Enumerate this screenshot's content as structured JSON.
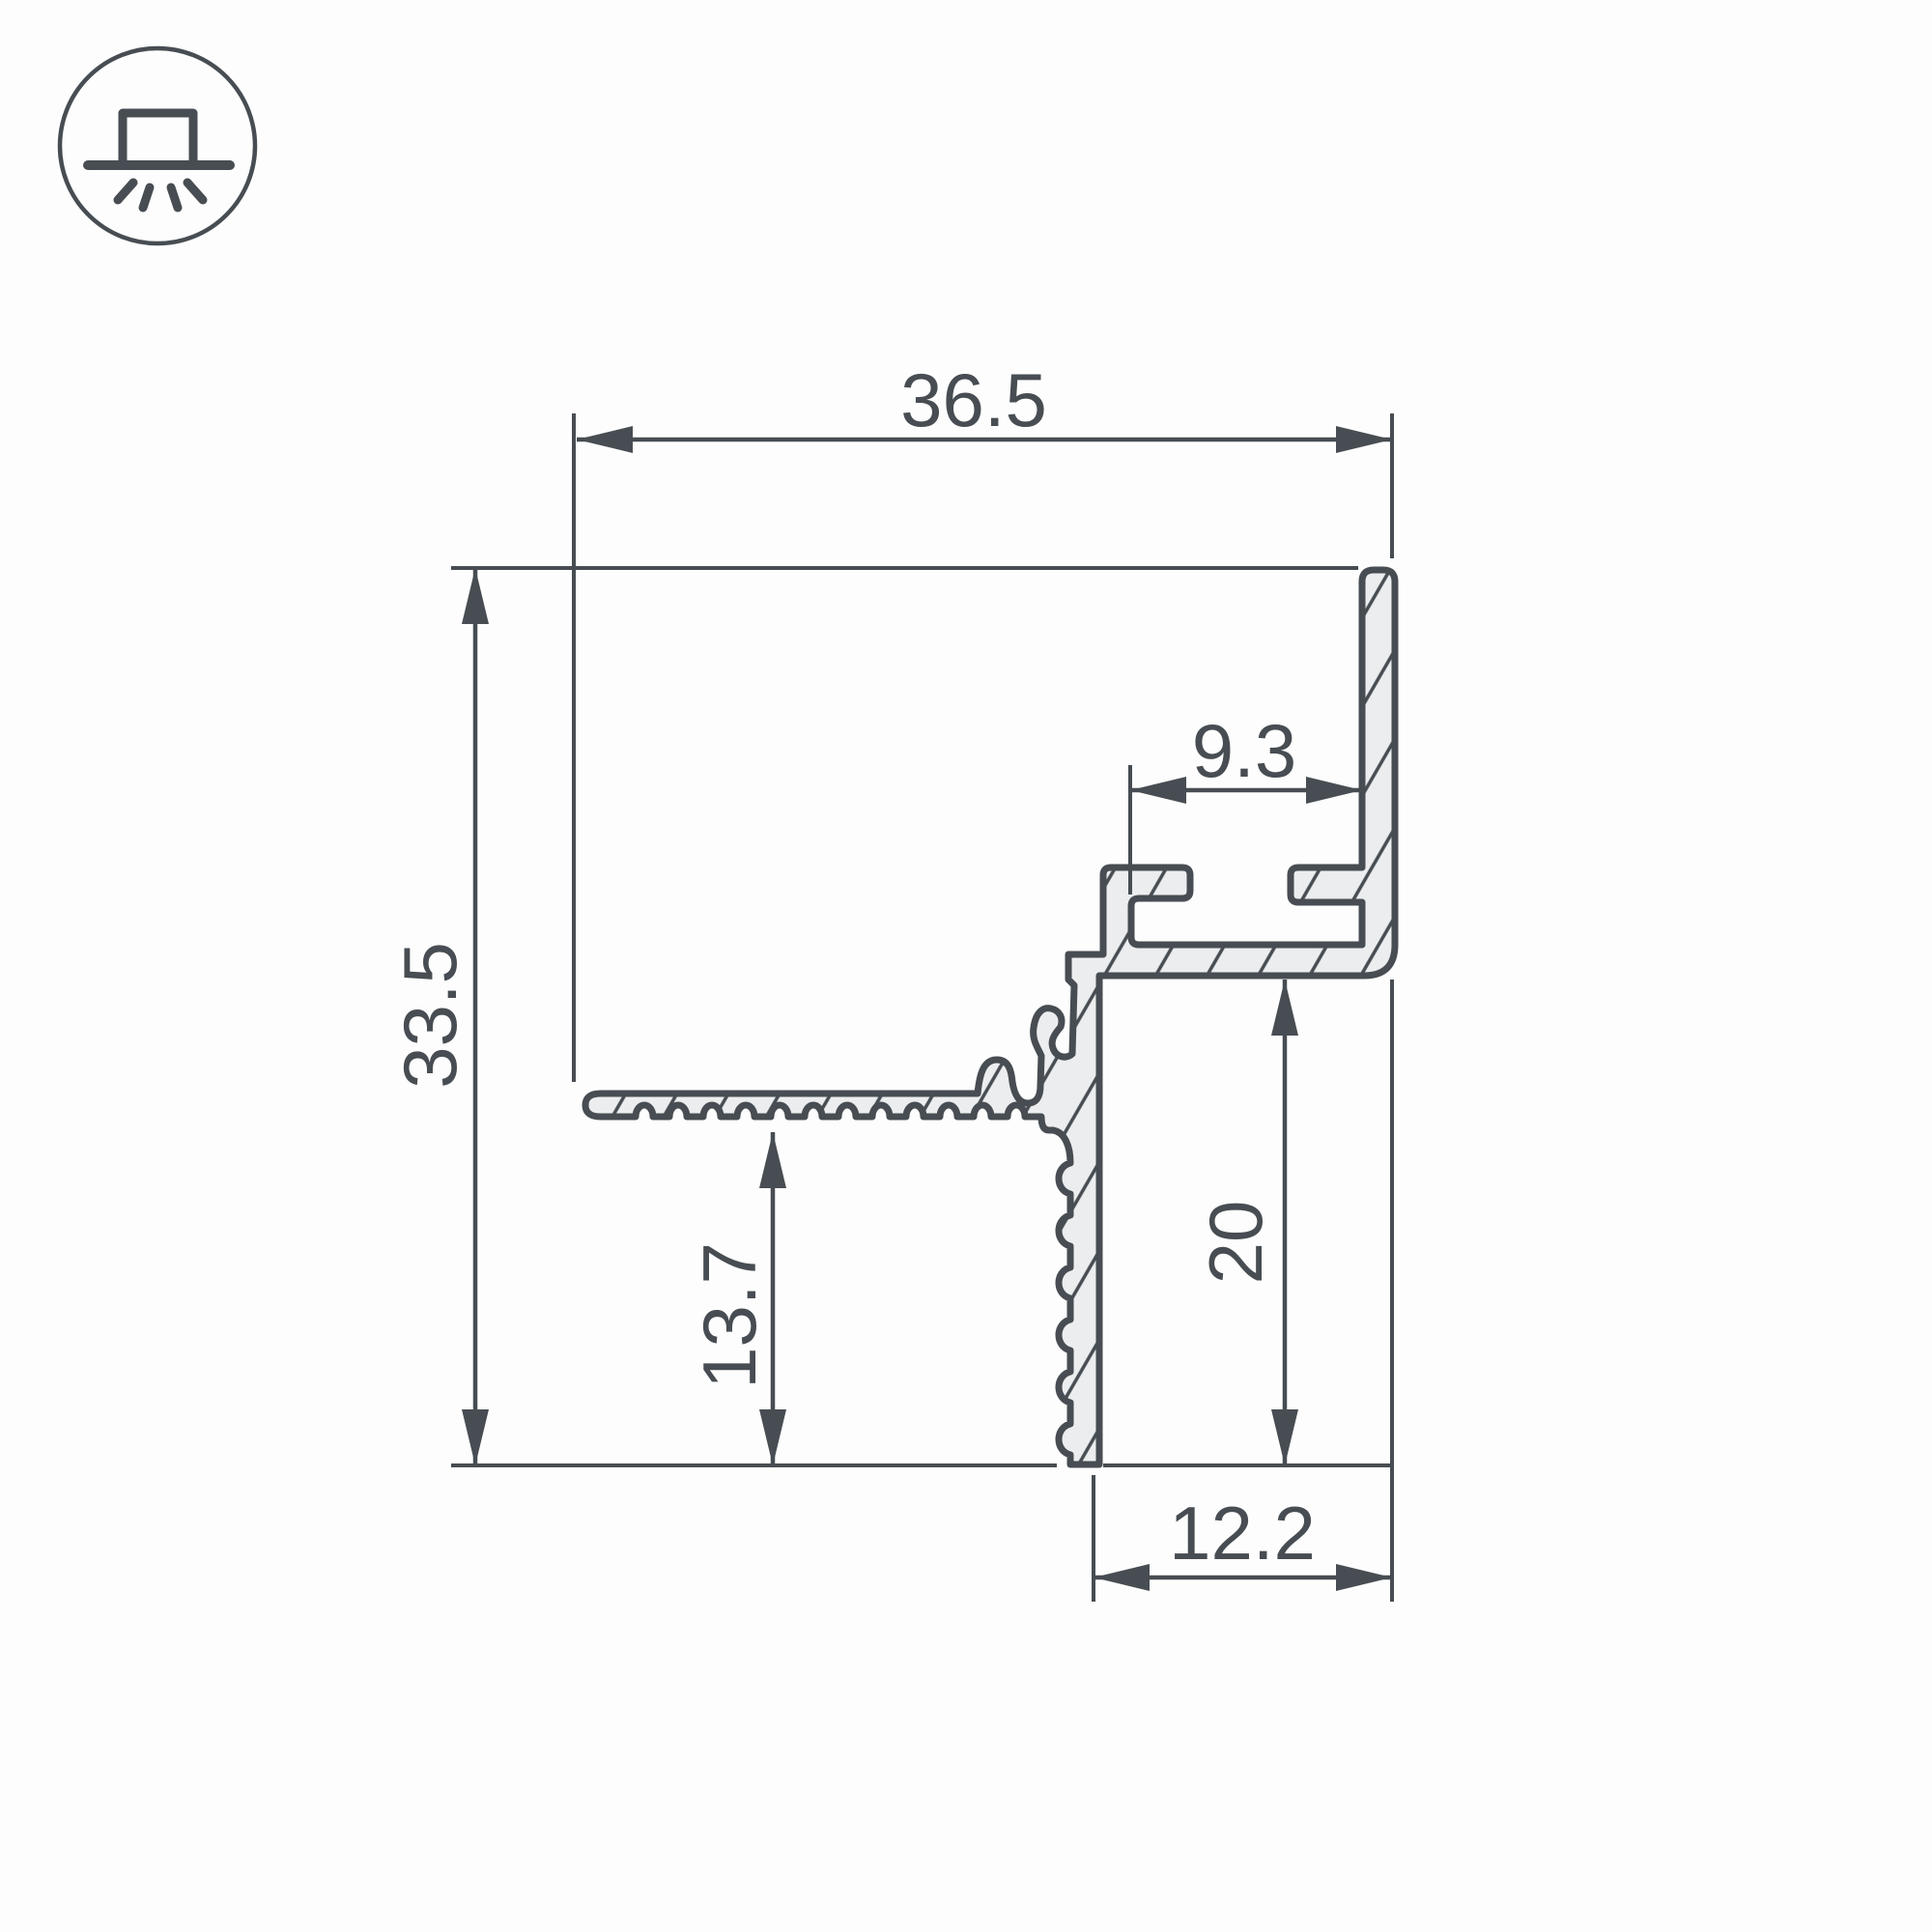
{
  "drawing": {
    "title": "LED profile cross-section dimension drawing",
    "icon": "recessed-ceiling-light-icon",
    "dimensions": {
      "overall_width": "36.5",
      "overall_height": "33.5",
      "slot_width": "9.3",
      "wall_height": "20",
      "flange_offset": "13.7",
      "foot_width": "12.2"
    },
    "colors": {
      "line": "#474d52",
      "profile_fill": "#ebedee",
      "background": "#fdfdfd"
    }
  }
}
